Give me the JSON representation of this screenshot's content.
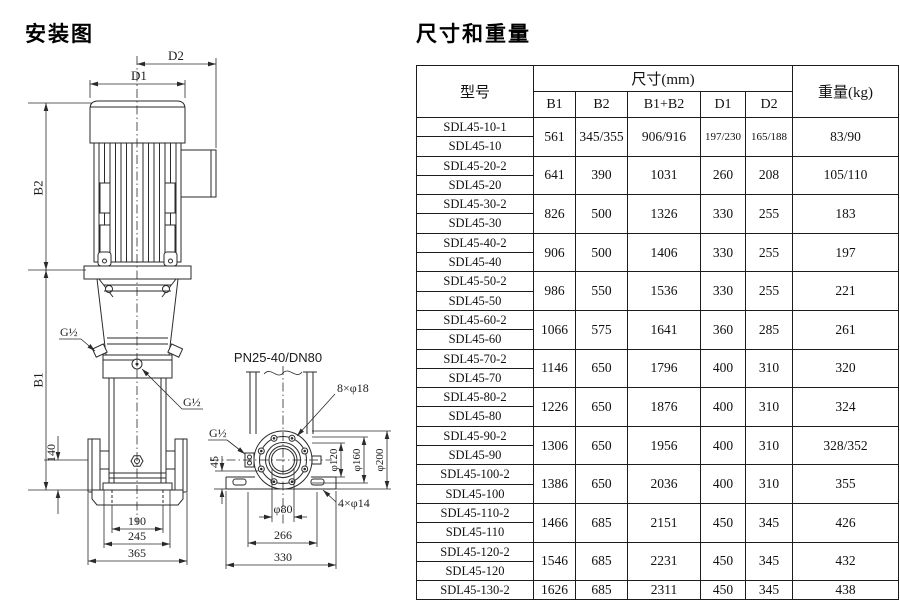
{
  "diagram": {
    "title": "安装图",
    "labels": {
      "d1": "D1",
      "d2": "D2",
      "b1": "B1",
      "b2": "B2",
      "g12": "G½",
      "n140": "140",
      "n190": "190",
      "n245": "245",
      "n365": "365",
      "pn": "PN25-40/DN80",
      "b8": "8×φ18",
      "b4": "4×φ14",
      "p120": "φ120",
      "p160": "φ160",
      "p200": "φ200",
      "p80": "φ80",
      "n45": "45",
      "n266": "266",
      "n330": "330"
    }
  },
  "table": {
    "title": "尺寸和重量",
    "header": {
      "model": "型号",
      "size": "尺寸(mm)",
      "sub": [
        "B1",
        "B2",
        "B1+B2",
        "D1",
        "D2"
      ],
      "weight": "重量(kg)"
    },
    "groups": [
      {
        "m1": "SDL45-10-1",
        "m2": "SDL45-10",
        "b1": "561",
        "b2": "345/355",
        "bb": "906/916",
        "d1": "197/230",
        "d2": "165/188",
        "w": "83/90"
      },
      {
        "m1": "SDL45-20-2",
        "m2": "SDL45-20",
        "b1": "641",
        "b2": "390",
        "bb": "1031",
        "d1": "260",
        "d2": "208",
        "w": "105/110"
      },
      {
        "m1": "SDL45-30-2",
        "m2": "SDL45-30",
        "b1": "826",
        "b2": "500",
        "bb": "1326",
        "d1": "330",
        "d2": "255",
        "w": "183"
      },
      {
        "m1": "SDL45-40-2",
        "m2": "SDL45-40",
        "b1": "906",
        "b2": "500",
        "bb": "1406",
        "d1": "330",
        "d2": "255",
        "w": "197"
      },
      {
        "m1": "SDL45-50-2",
        "m2": "SDL45-50",
        "b1": "986",
        "b2": "550",
        "bb": "1536",
        "d1": "330",
        "d2": "255",
        "w": "221"
      },
      {
        "m1": "SDL45-60-2",
        "m2": "SDL45-60",
        "b1": "1066",
        "b2": "575",
        "bb": "1641",
        "d1": "360",
        "d2": "285",
        "w": "261"
      },
      {
        "m1": "SDL45-70-2",
        "m2": "SDL45-70",
        "b1": "1146",
        "b2": "650",
        "bb": "1796",
        "d1": "400",
        "d2": "310",
        "w": "320"
      },
      {
        "m1": "SDL45-80-2",
        "m2": "SDL45-80",
        "b1": "1226",
        "b2": "650",
        "bb": "1876",
        "d1": "400",
        "d2": "310",
        "w": "324"
      },
      {
        "m1": "SDL45-90-2",
        "m2": "SDL45-90",
        "b1": "1306",
        "b2": "650",
        "bb": "1956",
        "d1": "400",
        "d2": "310",
        "w": "328/352"
      },
      {
        "m1": "SDL45-100-2",
        "m2": "SDL45-100",
        "b1": "1386",
        "b2": "650",
        "bb": "2036",
        "d1": "400",
        "d2": "310",
        "w": "355"
      },
      {
        "m1": "SDL45-110-2",
        "m2": "SDL45-110",
        "b1": "1466",
        "b2": "685",
        "bb": "2151",
        "d1": "450",
        "d2": "345",
        "w": "426"
      },
      {
        "m1": "SDL45-120-2",
        "m2": "SDL45-120",
        "b1": "1546",
        "b2": "685",
        "bb": "2231",
        "d1": "450",
        "d2": "345",
        "w": "432"
      },
      {
        "m1": "SDL45-130-2",
        "b1": "1626",
        "b2": "685",
        "bb": "2311",
        "d1": "450",
        "d2": "345",
        "w": "438"
      }
    ]
  }
}
